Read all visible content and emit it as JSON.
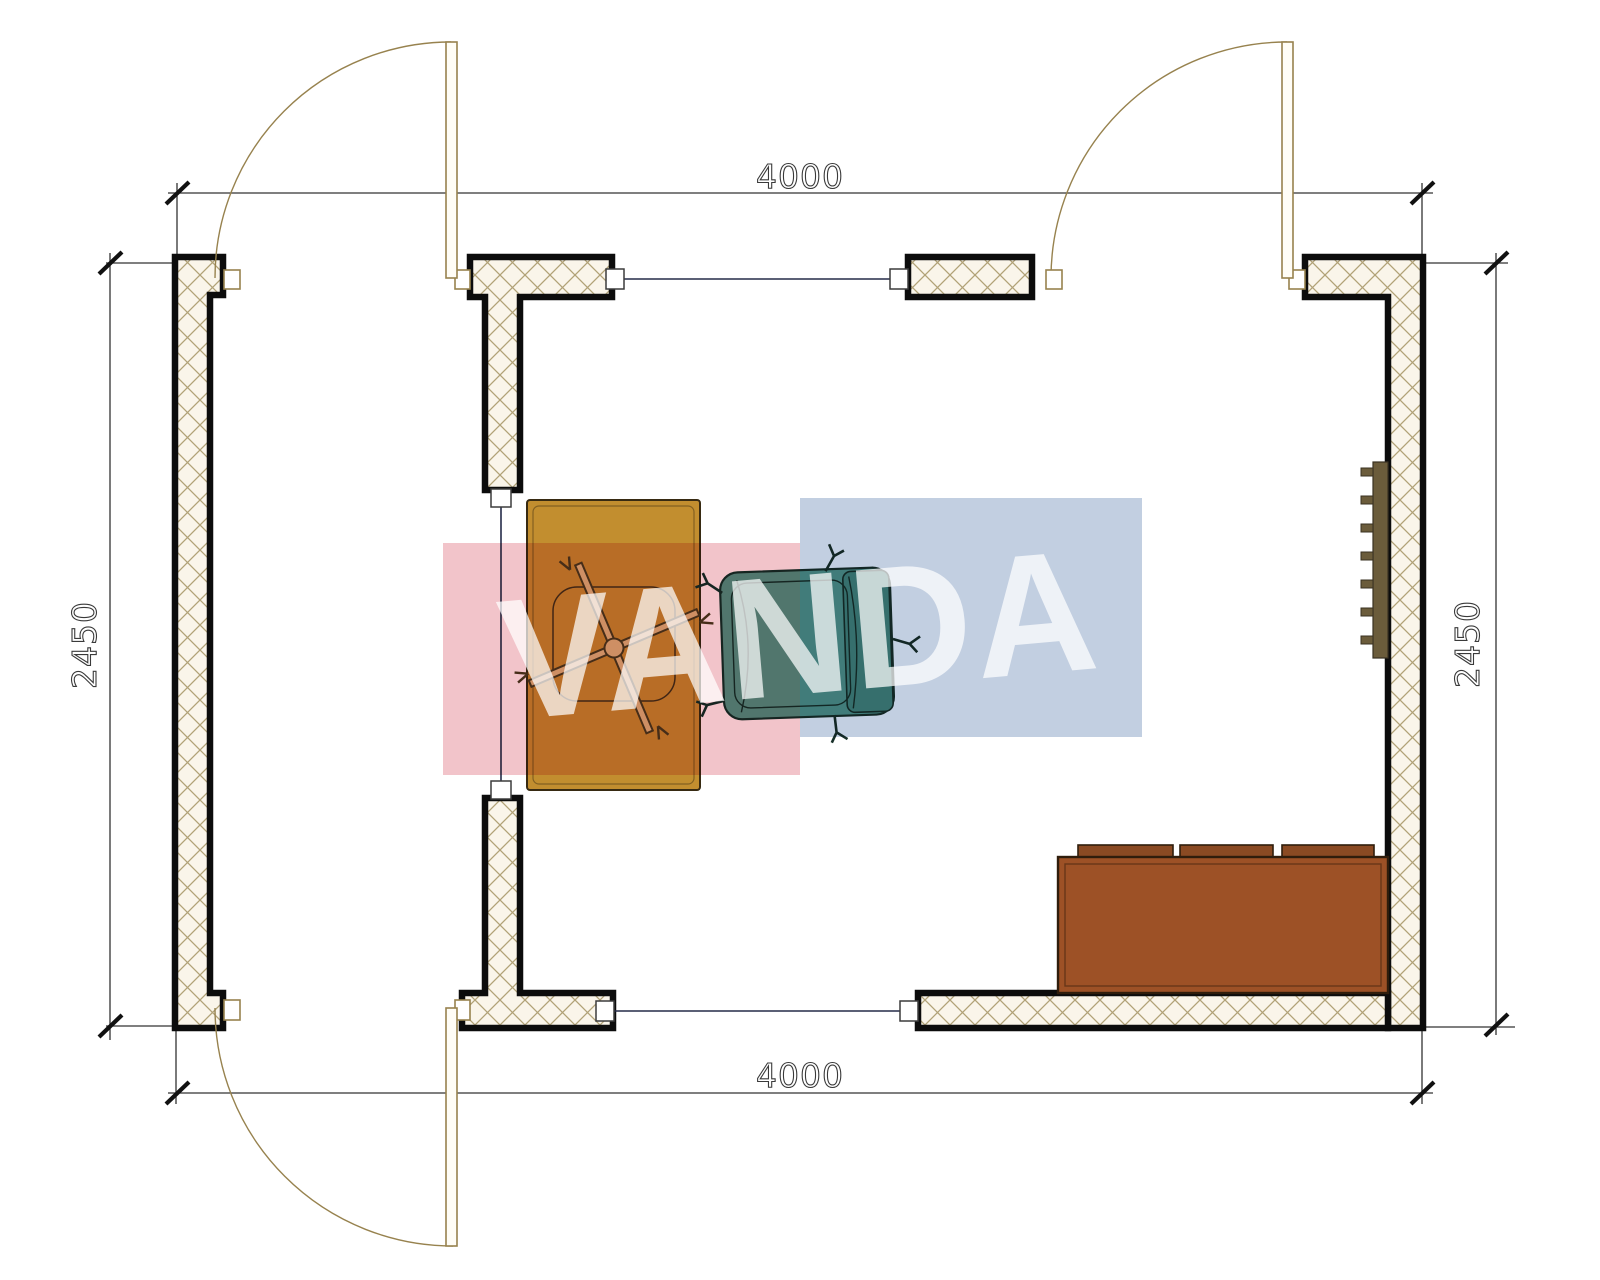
{
  "drawing": {
    "type": "floor-plan",
    "background": "#ffffff"
  },
  "dimensions": {
    "top": "4000",
    "bottom": "4000",
    "left": "2450",
    "right": "2450"
  },
  "watermark": {
    "text": "VANDA"
  },
  "colors": {
    "wall-outline": "#0c0c0c",
    "wall-fill": "#faf5ea",
    "hatch-line": "#b1a277",
    "door": "#97824e",
    "window-line": "#252b49",
    "dim": "#333333",
    "desk": "#c28e2f",
    "desk-outline": "#372a12",
    "chair-base": "#d9ba7e",
    "armchair": "#55998a",
    "armchair-dark": "#47897b",
    "armchair-outline": "#173029",
    "sofa": "#9d5126",
    "sofa-cushion": "#8a4a23",
    "sofa-outline": "#2f1d0c",
    "radiator": "#6b5c3b",
    "wm-pink": "#f2c4ca",
    "wm-blue": "#c2cfe1"
  },
  "elements": {
    "doors": [
      "door-top-left",
      "door-top-right",
      "door-bottom-left"
    ],
    "windows": [
      "window-top",
      "window-bottom",
      "glazed-partition"
    ],
    "furniture": [
      "desk",
      "task-chair",
      "armchair",
      "sofa",
      "radiator"
    ]
  }
}
